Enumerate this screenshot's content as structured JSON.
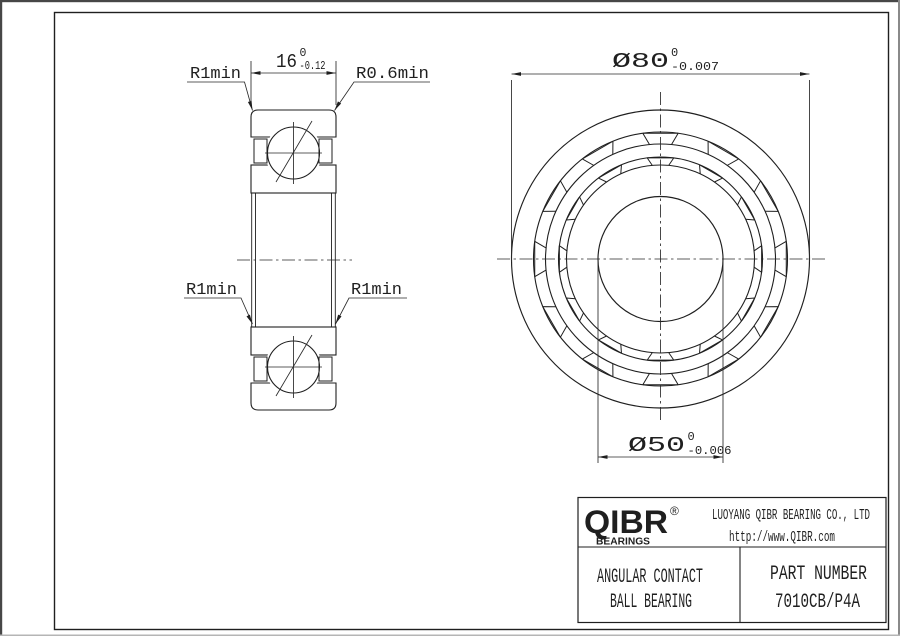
{
  "section_view": {
    "width_dim": {
      "value": "16",
      "tol_upper": "0",
      "tol_lower": "-0.12"
    },
    "radius_labels": {
      "top_left": "R1min",
      "top_right": "R0.6min",
      "bottom_left": "R1min",
      "bottom_right": "R1min"
    }
  },
  "front_view": {
    "outer_dia_dim": {
      "value": "Ø80",
      "tol_upper": "0",
      "tol_lower": "-0.007"
    },
    "bore_dia_dim": {
      "value": "Ø50",
      "tol_upper": "0",
      "tol_lower": "-0.006"
    }
  },
  "title_block": {
    "logo_wordmark": "QIBR",
    "logo_registered": "®",
    "logo_subtext": "BEARINGS",
    "company_name": "LUOYANG QIBR BEARING CO., LTD",
    "website": "http://www.QIBR.com",
    "product_type_line1": "ANGULAR CONTACT",
    "product_type_line2": "BALL BEARING",
    "part_number_label": "PART  NUMBER",
    "part_number_value": "7010CB/P4A"
  },
  "colors": {
    "line_color": "#1f1f1f",
    "background": "#ffffff"
  }
}
